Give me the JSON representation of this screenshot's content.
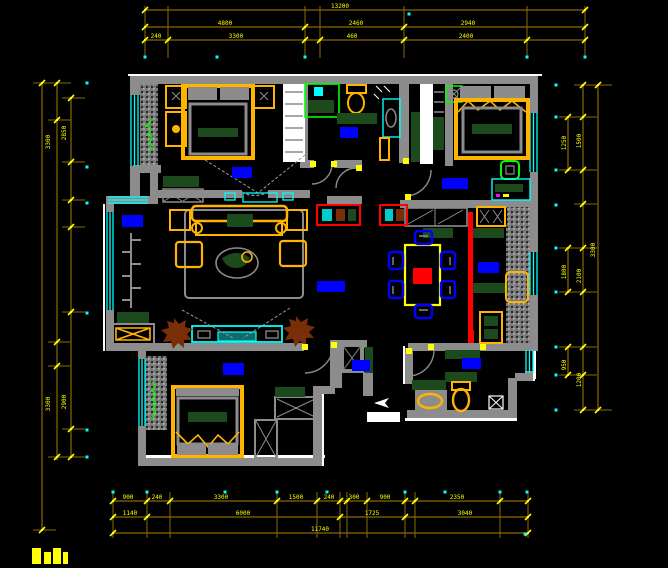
{
  "drawing": {
    "title": "residential floor plan",
    "background": "#000000",
    "width": 668,
    "height": 568
  },
  "palette": {
    "wall_gray": "#8c8c8c",
    "hatch_gray": "#7a7a7a",
    "dim_line": "#8a6a00",
    "dim_text": "#ffff00",
    "window_cyan": "#00ffff",
    "furniture_orange": "#ffb400",
    "dark_green": "#1d4a1d",
    "bright_green": "#00ff00",
    "label_blue": "#0000ff",
    "accent_red": "#ff0000",
    "plant_brown": "#7a2e08",
    "white": "#ffffff"
  },
  "room_labels": [
    {
      "name": "bedroom-master-label",
      "x": 232,
      "y": 167,
      "w": 20,
      "h": 11
    },
    {
      "name": "bathroom-label",
      "x": 340,
      "y": 127,
      "w": 18,
      "h": 11
    },
    {
      "name": "bedroom-second-label",
      "x": 442,
      "y": 178,
      "w": 26,
      "h": 11
    },
    {
      "name": "balcony-label",
      "x": 122,
      "y": 215,
      "w": 21,
      "h": 12
    },
    {
      "name": "living-dining-label",
      "x": 317,
      "y": 281,
      "w": 28,
      "h": 11
    },
    {
      "name": "kitchen-label",
      "x": 478,
      "y": 262,
      "w": 21,
      "h": 11
    },
    {
      "name": "entry-hall-label",
      "x": 352,
      "y": 360,
      "w": 18,
      "h": 11
    },
    {
      "name": "guest-bathroom-label",
      "x": 462,
      "y": 358,
      "w": 19,
      "h": 11
    },
    {
      "name": "bedroom-third-label",
      "x": 223,
      "y": 363,
      "w": 21,
      "h": 12
    }
  ],
  "furniture_icons": [
    "double-bed",
    "single-bed",
    "nightstand",
    "dresser",
    "wardrobe-hangers",
    "sofa-set",
    "coffee-table-plant",
    "tv-cabinet",
    "potted-plant",
    "dining-table",
    "dining-chair",
    "kitchen-counter",
    "sink",
    "stove",
    "toilet",
    "washbasin",
    "shower-enclosure",
    "water-heater",
    "desk",
    "desk-chair",
    "shoe-console",
    "duct-shaft",
    "balcony-rack",
    "entry-arrow"
  ],
  "dimensions": {
    "top": {
      "orientation": "h",
      "ext": {
        "from": 6,
        "to": 58
      },
      "rows": [
        {
          "y": 10,
          "x1": 145,
          "x2": 585,
          "ticks": [
            145,
            585
          ],
          "labels": [
            {
              "x": 340,
              "t": "13200"
            }
          ]
        },
        {
          "y": 27,
          "x1": 145,
          "x2": 585,
          "ticks": [
            145,
            305,
            404,
            585
          ],
          "labels": [
            {
              "x": 225,
              "t": "4800"
            },
            {
              "x": 356,
              "t": "2460"
            },
            {
              "x": 468,
              "t": "2940"
            }
          ]
        },
        {
          "y": 40,
          "x1": 145,
          "x2": 585,
          "ticks": [
            145,
            168,
            305,
            320,
            404,
            527,
            585
          ],
          "labels": [
            {
              "x": 156,
              "t": "240"
            },
            {
              "x": 236,
              "t": "3300"
            },
            {
              "x": 352,
              "t": "460"
            },
            {
              "x": 466,
              "t": "2400"
            }
          ]
        }
      ]
    },
    "bottom": {
      "orientation": "h",
      "ext": {
        "from": 492,
        "to": 538
      },
      "rows": [
        {
          "y": 501,
          "x1": 113,
          "x2": 528,
          "ticks": [
            113,
            147,
            170,
            277,
            317,
            340,
            347,
            367,
            405,
            415,
            500,
            528
          ],
          "labels": [
            {
              "x": 128,
              "t": "900"
            },
            {
              "x": 157,
              "t": "240"
            },
            {
              "x": 221,
              "t": "3300"
            },
            {
              "x": 296,
              "t": "1500"
            },
            {
              "x": 329,
              "t": "240"
            },
            {
              "x": 354,
              "t": "300"
            },
            {
              "x": 385,
              "t": "900"
            },
            {
              "x": 457,
              "t": "2350"
            }
          ]
        },
        {
          "y": 517,
          "x1": 113,
          "x2": 528,
          "ticks": [
            113,
            147,
            340,
            405,
            528
          ],
          "labels": [
            {
              "x": 130,
              "t": "1140"
            },
            {
              "x": 243,
              "t": "6000"
            },
            {
              "x": 372,
              "t": "1725"
            },
            {
              "x": 465,
              "t": "3040"
            }
          ]
        },
        {
          "y": 533,
          "x1": 113,
          "x2": 528,
          "ticks": [
            113,
            528
          ],
          "labels": [
            {
              "x": 320,
              "t": "11740"
            }
          ]
        }
      ]
    },
    "left": {
      "orientation": "v",
      "lines": [
        {
          "x": 42,
          "y1": 83,
          "y2": 530,
          "ticks": [
            83,
            530
          ]
        },
        {
          "x": 57,
          "y1": 83,
          "y2": 460,
          "ticks": [
            83,
            120,
            342,
            366,
            457
          ]
        },
        {
          "x": 71,
          "y1": 98,
          "y2": 457,
          "ticks": [
            98,
            162,
            200,
            227,
            312,
            429,
            457
          ]
        }
      ],
      "labels": [
        {
          "x": 50,
          "y": 142,
          "t": "3300"
        },
        {
          "x": 66,
          "y": 133,
          "t": "2850"
        },
        {
          "x": 50,
          "y": 404,
          "t": "3300"
        },
        {
          "x": 66,
          "y": 402,
          "t": "2900"
        }
      ]
    },
    "right": {
      "orientation": "v",
      "lines": [
        {
          "x": 583,
          "y1": 85,
          "y2": 410,
          "ticks": [
            85,
            117,
            170,
            204,
            248,
            292,
            347,
            375,
            410
          ]
        },
        {
          "x": 598,
          "y1": 85,
          "y2": 410,
          "ticks": [
            85,
            410
          ]
        },
        {
          "x": 568,
          "y1": 117,
          "y2": 170,
          "ticks": [
            117,
            170
          ]
        },
        {
          "x": 568,
          "y1": 248,
          "y2": 292,
          "ticks": [
            248,
            292
          ]
        },
        {
          "x": 568,
          "y1": 347,
          "y2": 375,
          "ticks": [
            347,
            375
          ]
        }
      ],
      "labels": [
        {
          "x": 566,
          "y": 143,
          "t": "1250"
        },
        {
          "x": 581,
          "y": 141,
          "t": "1500"
        },
        {
          "x": 595,
          "y": 250,
          "t": "3300"
        },
        {
          "x": 566,
          "y": 272,
          "t": "1800"
        },
        {
          "x": 581,
          "y": 276,
          "t": "2100"
        },
        {
          "x": 566,
          "y": 365,
          "t": "950"
        },
        {
          "x": 581,
          "y": 380,
          "t": "1200"
        }
      ]
    }
  },
  "osnap_dots": [
    [
      145,
      57
    ],
    [
      217,
      57
    ],
    [
      305,
      57
    ],
    [
      409,
      14
    ],
    [
      527,
      57
    ],
    [
      585,
      57
    ],
    [
      113,
      492
    ],
    [
      147,
      492
    ],
    [
      225,
      492
    ],
    [
      277,
      492
    ],
    [
      327,
      492
    ],
    [
      405,
      492
    ],
    [
      445,
      492
    ],
    [
      500,
      492
    ],
    [
      527,
      492
    ],
    [
      525,
      534
    ],
    [
      87,
      83
    ],
    [
      87,
      167
    ],
    [
      87,
      203
    ],
    [
      87,
      313
    ],
    [
      87,
      430
    ],
    [
      87,
      457
    ],
    [
      556,
      85
    ],
    [
      556,
      117
    ],
    [
      556,
      170
    ],
    [
      556,
      205
    ],
    [
      556,
      248
    ],
    [
      556,
      292
    ],
    [
      556,
      347
    ],
    [
      556,
      375
    ],
    [
      556,
      410
    ]
  ],
  "door_hinges": [
    [
      310,
      161
    ],
    [
      331,
      161
    ],
    [
      356,
      165
    ],
    [
      403,
      158
    ],
    [
      405,
      194
    ],
    [
      302,
      344
    ],
    [
      331,
      342
    ],
    [
      406,
      348
    ],
    [
      428,
      344
    ],
    [
      480,
      344
    ]
  ],
  "corner_marks": [
    [
      32,
      548,
      9,
      16
    ],
    [
      44,
      552,
      7,
      12
    ],
    [
      53,
      548,
      8,
      16
    ],
    [
      63,
      552,
      5,
      12
    ]
  ]
}
